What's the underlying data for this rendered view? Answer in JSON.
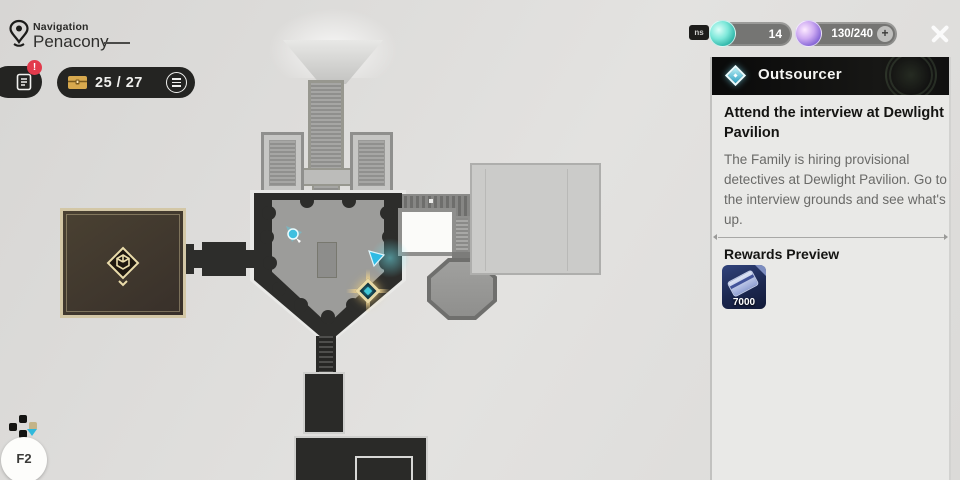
{
  "header": {
    "nav_label": "Navigation",
    "location": "Penacony"
  },
  "toolbar": {
    "chest_count": "25 / 27",
    "alert_label": "!"
  },
  "currency_bar": {
    "badge_label": "ns",
    "jade_count": "14",
    "power_count": "130/240",
    "add_label": "+"
  },
  "mission": {
    "category": "Outsourcer",
    "title": "Attend the interview at Dewlight Pavilion",
    "description": "The Family is hiring provisional detectives at Dewlight Pavilion. Go to the interview grounds and see what's up.",
    "rewards_label": "Rewards Preview",
    "reward_item": "credit",
    "reward_amount": "7000"
  },
  "hotkey": {
    "label": "F2"
  },
  "colors": {
    "accent_cyan": "#41c8d8",
    "quest_gold": "#ead9a4",
    "alert_red": "#e23b4c",
    "panel_bg": "#e9e9e7",
    "header_bg": "#101010",
    "reward_navy": "#1c2850",
    "chest_gold": "#d8a94e"
  }
}
